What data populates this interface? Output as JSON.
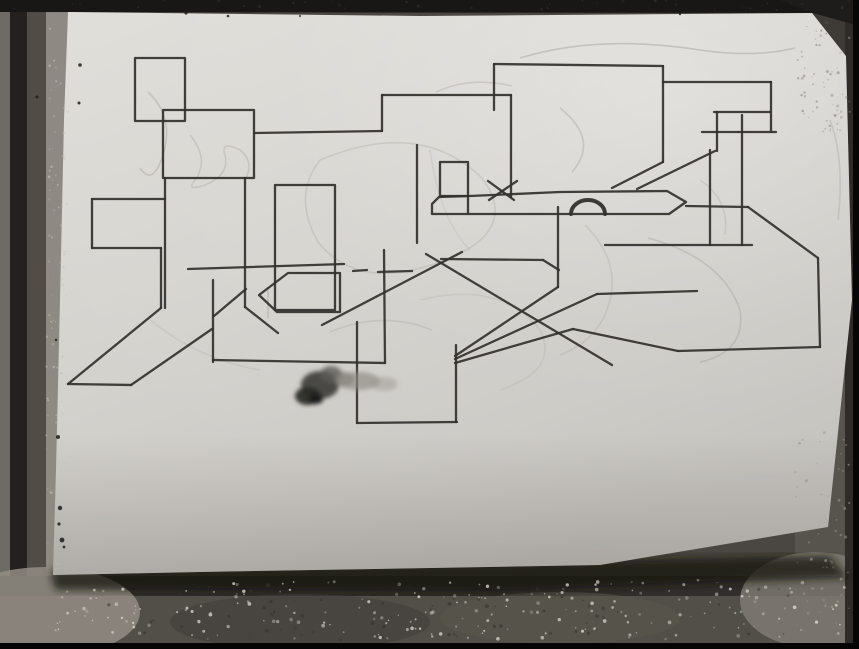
{
  "meta": {
    "description": "Grayscale photograph of a white paper sheet with an abstract geometric black marker drawing (overlapping rectangles, long diagonals, a pointed banner bar, a small semicircle and an ink blot), lying on a dark speckled tile surface",
    "canvas": {
      "width": 859,
      "height": 649
    }
  },
  "colors": {
    "tile_base": "#4a4641",
    "tile_light_strip": "#8e8982",
    "tile_dark_strip": "#23201d",
    "black_frame": "#060606",
    "paper_light": "#dedcd7",
    "paper_mid": "#d2d0cb",
    "paper_shadow": "#b6b4af",
    "marker_ink": "#33312d",
    "pencil": "#8f8c86",
    "ink_blot_dark": "#26241f"
  },
  "background": {
    "shapes": [
      {
        "type": "rect",
        "x": 0,
        "y": 0,
        "w": 859,
        "h": 649,
        "fill": "#4a4641",
        "opacity": 1
      },
      {
        "type": "rect",
        "x": 0,
        "y": 0,
        "w": 10,
        "h": 649,
        "fill": "#6e6a64",
        "opacity": 1
      },
      {
        "type": "rect",
        "x": 10,
        "y": 0,
        "w": 17,
        "h": 649,
        "fill": "#23201d",
        "opacity": 1
      },
      {
        "type": "rect",
        "x": 27,
        "y": 0,
        "w": 19,
        "h": 649,
        "fill": "#514c46",
        "opacity": 1
      },
      {
        "type": "rect",
        "x": 46,
        "y": 0,
        "w": 22,
        "h": 580,
        "fill": "#8e8982",
        "opacity": 1
      },
      {
        "type": "rect",
        "x": 795,
        "y": 0,
        "w": 58,
        "h": 649,
        "fill": "#57534d",
        "opacity": 1
      },
      {
        "type": "polygon",
        "points": [
          [
            770,
            0
          ],
          [
            859,
            0
          ],
          [
            859,
            120
          ],
          [
            800,
            40
          ]
        ],
        "fill": "#3e3a35",
        "opacity": 1
      },
      {
        "type": "rect",
        "x": 0,
        "y": 576,
        "w": 859,
        "h": 22,
        "fill": "#312e2b",
        "opacity": 1
      },
      {
        "type": "rect",
        "x": 0,
        "y": 596,
        "w": 859,
        "h": 47,
        "fill": "#524e48",
        "opacity": 1
      },
      {
        "type": "ellipse",
        "cx": 45,
        "cy": 612,
        "rx": 95,
        "ry": 45,
        "fill": "#938d85",
        "opacity": 0.85
      },
      {
        "type": "ellipse",
        "cx": 815,
        "cy": 600,
        "rx": 75,
        "ry": 48,
        "fill": "#827d76",
        "opacity": 0.8
      },
      {
        "type": "ellipse",
        "cx": 300,
        "cy": 622,
        "rx": 130,
        "ry": 28,
        "fill": "#45423d",
        "opacity": 0.7
      },
      {
        "type": "ellipse",
        "cx": 560,
        "cy": 618,
        "rx": 120,
        "ry": 26,
        "fill": "#5a564f",
        "opacity": 0.6
      },
      {
        "type": "rect",
        "x": 845,
        "y": 0,
        "w": 8,
        "h": 649,
        "fill": "#2e2b28",
        "opacity": 1
      },
      {
        "type": "polygon",
        "points": [
          [
            0,
            0
          ],
          [
            859,
            0
          ],
          [
            859,
            5
          ],
          [
            815,
            13
          ],
          [
            0,
            12
          ]
        ],
        "fill": "#181715",
        "opacity": 1
      },
      {
        "type": "polygon",
        "points": [
          [
            780,
            0
          ],
          [
            859,
            0
          ],
          [
            859,
            26
          ],
          [
            813,
            13
          ]
        ],
        "fill": "#1d1c1a",
        "opacity": 1
      },
      {
        "type": "rect",
        "x": 853,
        "y": 0,
        "w": 6,
        "h": 649,
        "fill": "#060606",
        "opacity": 1
      },
      {
        "type": "rect",
        "x": 0,
        "y": 643,
        "w": 859,
        "h": 6,
        "fill": "#050505",
        "opacity": 1
      }
    ],
    "speckle_bands": [
      {
        "x": 55,
        "y": 580,
        "w": 790,
        "h": 60,
        "count": 220,
        "color": "#d8d4cc",
        "rmin": 0.6,
        "rmax": 1.9,
        "omin": 0.25,
        "omax": 0.85
      },
      {
        "x": 46,
        "y": 20,
        "w": 22,
        "h": 550,
        "count": 90,
        "color": "#c2bcb2",
        "rmin": 0.5,
        "rmax": 1.4,
        "omin": 0.25,
        "omax": 0.7
      },
      {
        "x": 795,
        "y": 15,
        "w": 55,
        "h": 120,
        "count": 60,
        "color": "#8d8880",
        "rmin": 0.5,
        "rmax": 1.5,
        "omin": 0.3,
        "omax": 0.7
      },
      {
        "x": 795,
        "y": 430,
        "w": 55,
        "h": 200,
        "count": 50,
        "color": "#9a948b",
        "rmin": 0.5,
        "rmax": 1.6,
        "omin": 0.3,
        "omax": 0.7
      },
      {
        "x": 100,
        "y": 585,
        "w": 700,
        "h": 55,
        "count": 70,
        "color": "#34312c",
        "rmin": 0.7,
        "rmax": 2.0,
        "omin": 0.3,
        "omax": 0.7
      },
      {
        "x": 0,
        "y": 0,
        "w": 859,
        "h": 10,
        "count": 40,
        "color": "#3a3835",
        "rmin": 0.6,
        "rmax": 1.6,
        "omin": 0.3,
        "omax": 0.6
      }
    ]
  },
  "paper": {
    "outline": [
      [
        68,
        12
      ],
      [
        420,
        16
      ],
      [
        812,
        13
      ],
      [
        846,
        56
      ],
      [
        852,
        300
      ],
      [
        828,
        527
      ],
      [
        600,
        565
      ],
      [
        200,
        572
      ],
      [
        53,
        575
      ],
      [
        56,
        470
      ],
      [
        60,
        300
      ],
      [
        64,
        120
      ]
    ],
    "shadow": [
      [
        50,
        570
      ],
      [
        830,
        556
      ],
      [
        848,
        578
      ],
      [
        500,
        592
      ],
      [
        55,
        590
      ]
    ]
  },
  "drawing": {
    "stroke": "#33312d",
    "stroke_width": 2.3,
    "rects": [
      {
        "x": 135,
        "y": 58,
        "w": 50,
        "h": 63
      },
      {
        "x": 163,
        "y": 110,
        "w": 91,
        "h": 68
      },
      {
        "x": 275,
        "y": 185,
        "w": 60,
        "h": 125
      },
      {
        "x": 440,
        "y": 162,
        "w": 28,
        "h": 34
      }
    ],
    "polygons": [
      {
        "name": "banner-bar",
        "closed": true,
        "points": [
          [
            432,
            204
          ],
          [
            439,
            197
          ],
          [
            470,
            196
          ],
          [
            560,
            192
          ],
          [
            667,
            191
          ],
          [
            686,
            202
          ],
          [
            669,
            214
          ],
          [
            432,
            214
          ]
        ]
      },
      {
        "name": "pentagon",
        "closed": true,
        "points": [
          [
            259,
            295
          ],
          [
            288,
            273
          ],
          [
            340,
            273
          ],
          [
            340,
            312
          ],
          [
            277,
            312
          ]
        ]
      }
    ],
    "arcs": [
      {
        "name": "semicircle",
        "d": "M605 214 A17 14 0 0 0 571 214",
        "width": 4
      }
    ],
    "segments": [
      [
        255,
        133,
        382,
        131
      ],
      [
        382,
        95,
        382,
        131
      ],
      [
        382,
        95,
        511,
        95
      ],
      [
        511,
        95,
        511,
        197
      ],
      [
        494,
        64,
        494,
        110
      ],
      [
        494,
        64,
        663,
        66
      ],
      [
        663,
        66,
        663,
        162
      ],
      [
        663,
        162,
        612,
        188
      ],
      [
        663,
        82,
        771,
        82
      ],
      [
        771,
        82,
        771,
        131
      ],
      [
        702,
        132,
        776,
        132
      ],
      [
        714,
        112,
        770,
        112
      ],
      [
        717,
        112,
        717,
        151
      ],
      [
        637,
        189,
        715,
        151
      ],
      [
        710,
        150,
        710,
        245
      ],
      [
        742,
        115,
        742,
        245
      ],
      [
        605,
        245,
        752,
        245
      ],
      [
        686,
        206,
        748,
        207
      ],
      [
        748,
        207,
        818,
        258
      ],
      [
        818,
        258,
        820,
        347
      ],
      [
        678,
        351,
        820,
        347
      ],
      [
        573,
        329,
        678,
        351
      ],
      [
        455,
        363,
        573,
        329
      ],
      [
        558,
        207,
        558,
        287
      ],
      [
        455,
        356,
        558,
        287
      ],
      [
        455,
        359,
        597,
        294
      ],
      [
        597,
        294,
        697,
        291
      ],
      [
        426,
        254,
        612,
        365
      ],
      [
        322,
        325,
        462,
        252
      ],
      [
        188,
        269,
        344,
        264
      ],
      [
        353,
        271,
        367,
        270
      ],
      [
        378,
        272,
        412,
        271
      ],
      [
        441,
        259,
        543,
        260
      ],
      [
        543,
        260,
        559,
        270
      ],
      [
        92,
        199,
        165,
        199
      ],
      [
        92,
        199,
        92,
        248
      ],
      [
        92,
        248,
        161,
        248
      ],
      [
        161,
        248,
        161,
        308
      ],
      [
        165,
        178,
        165,
        308
      ],
      [
        161,
        308,
        68,
        384
      ],
      [
        68,
        384,
        131,
        385
      ],
      [
        131,
        385,
        212,
        329
      ],
      [
        213,
        280,
        213,
        362
      ],
      [
        246,
        289,
        214,
        316
      ],
      [
        245,
        178,
        245,
        307
      ],
      [
        245,
        307,
        278,
        333
      ],
      [
        213,
        360,
        385,
        363
      ],
      [
        384,
        250,
        385,
        363
      ],
      [
        357,
        322,
        357,
        423
      ],
      [
        357,
        423,
        457,
        422
      ],
      [
        456,
        345,
        456,
        422
      ],
      [
        417,
        145,
        417,
        243
      ],
      [
        468,
        196,
        468,
        213
      ],
      [
        488,
        181,
        514,
        200
      ],
      [
        517,
        181,
        489,
        200
      ]
    ]
  },
  "ink_blot": {
    "blobs": [
      {
        "cx": 320,
        "cy": 385,
        "rx": 19,
        "ry": 14,
        "fill": "#3c3b38",
        "opacity": 0.9
      },
      {
        "cx": 308,
        "cy": 396,
        "rx": 13,
        "ry": 9,
        "fill": "#2b2a27",
        "opacity": 0.95
      },
      {
        "cx": 331,
        "cy": 374,
        "rx": 11,
        "ry": 8,
        "fill": "#5c5a55",
        "opacity": 0.8
      },
      {
        "cx": 316,
        "cy": 399,
        "rx": 7,
        "ry": 5,
        "fill": "#1f1e1c",
        "opacity": 1
      },
      {
        "cx": 344,
        "cy": 379,
        "rx": 10,
        "ry": 7,
        "fill": "#77746e",
        "opacity": 0.7
      },
      {
        "cx": 358,
        "cy": 381,
        "rx": 22,
        "ry": 9,
        "fill": "#8d8a84",
        "opacity": 0.65
      },
      {
        "cx": 384,
        "cy": 384,
        "rx": 14,
        "ry": 7,
        "fill": "#9c9992",
        "opacity": 0.5
      }
    ]
  },
  "specks": {
    "color": "#1d1c1a",
    "dots": [
      [
        186,
        13,
        1.6
      ],
      [
        228,
        16,
        1.3
      ],
      [
        80,
        65,
        1.8
      ],
      [
        79,
        103,
        1.5
      ],
      [
        58,
        437,
        2.0
      ],
      [
        60,
        508,
        2.2
      ],
      [
        59,
        524,
        1.6
      ],
      [
        62,
        540,
        2.4
      ],
      [
        64,
        547,
        1.4
      ],
      [
        37,
        97,
        1.5
      ],
      [
        300,
        16,
        1.0
      ],
      [
        680,
        14,
        1.2
      ],
      [
        56,
        340,
        1.2
      ]
    ]
  },
  "pencil_marks": {
    "color": "#8f8c86",
    "paths": [
      {
        "d": "M520 58 Q600 34 700 50 Q755 58 795 48",
        "o": 0.35
      },
      {
        "d": "M320 160 Q420 118 482 178 Q522 232 440 262 Q358 292 318 242 Q292 196 320 160",
        "o": 0.22
      },
      {
        "d": "M560 108 Q600 140 572 172",
        "o": 0.3
      },
      {
        "d": "M648 238 Q722 258 740 310 Q746 352 700 362",
        "o": 0.28
      },
      {
        "d": "M148 92 Q176 118 162 158 Q152 186 140 168",
        "o": 0.3
      },
      {
        "d": "M436 92 Q470 76 512 86",
        "o": 0.25
      },
      {
        "d": "M330 332 Q382 310 432 330",
        "o": 0.22
      },
      {
        "d": "M585 225 Q620 260 610 300 Q600 340 560 355",
        "o": 0.2
      },
      {
        "d": "M700 180 Q730 200 725 235",
        "o": 0.22
      },
      {
        "d": "M190 135 Q210 160 195 180 Q185 192 205 185 Q230 175 225 155 Q220 140 240 150 Q255 162 245 180",
        "o": 0.25
      },
      {
        "d": "M420 300 Q500 280 540 330 Q560 370 500 390",
        "o": 0.16
      },
      {
        "d": "M150 320 Q200 360 260 370",
        "o": 0.15
      },
      {
        "d": "M268 290 L268 318",
        "o": 0.3
      },
      {
        "d": "M430 150 Q440 220 470 250",
        "o": 0.15
      },
      {
        "d": "M830 120 Q845 160 838 220",
        "o": 0.25
      }
    ]
  }
}
